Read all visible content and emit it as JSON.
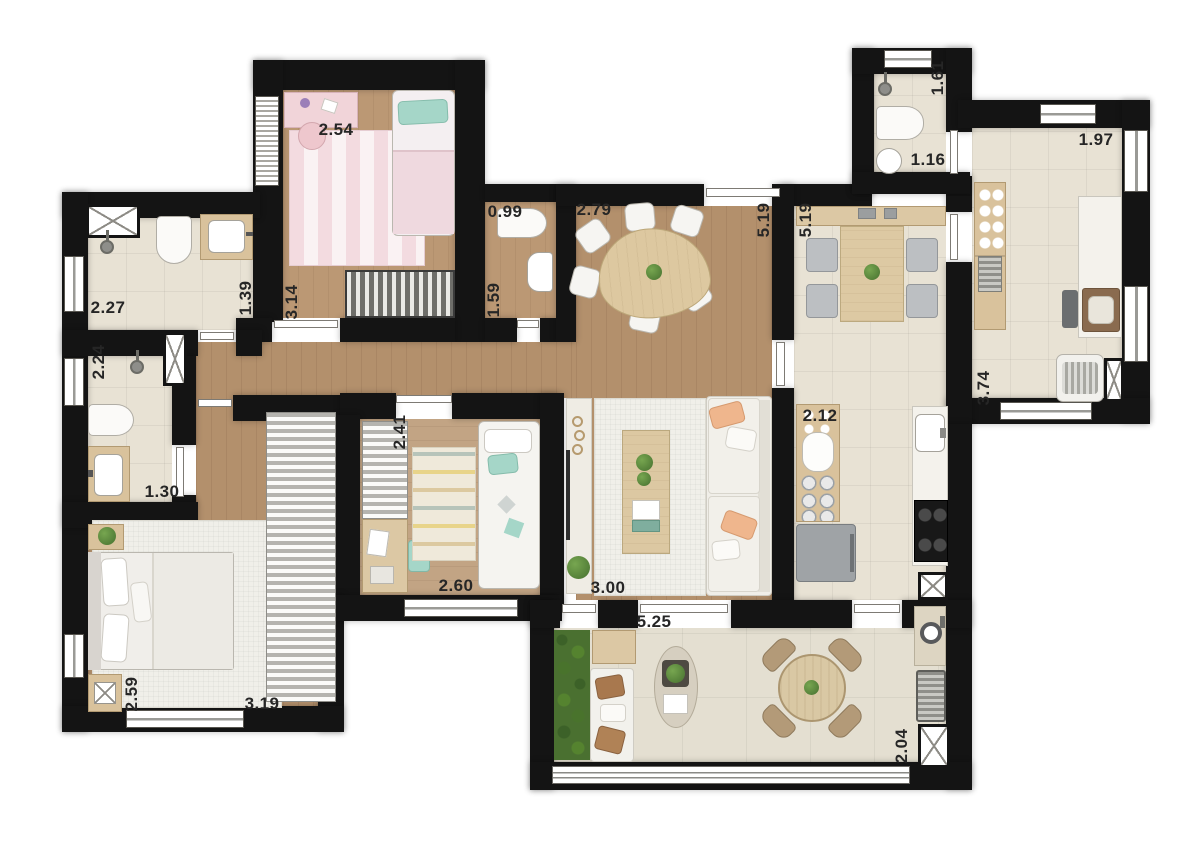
{
  "plan": {
    "type": "apartment-floor-plan",
    "unit_hint": "meters",
    "dimensions": [
      {
        "room": "child-bedroom-1",
        "value": "2.54",
        "orientation": "horizontal"
      },
      {
        "room": "bathroom-top-right",
        "value": "1.61",
        "orientation": "vertical"
      },
      {
        "room": "laundry",
        "value": "1.97",
        "orientation": "horizontal"
      },
      {
        "room": "bathroom-top-right",
        "value": "1.16",
        "orientation": "horizontal"
      },
      {
        "room": "lavatory",
        "value": "0.99",
        "orientation": "horizontal"
      },
      {
        "room": "dining-room",
        "value": "2.79",
        "orientation": "horizontal"
      },
      {
        "room": "dining-room",
        "value": "5.19",
        "orientation": "vertical"
      },
      {
        "room": "kitchen",
        "value": "5.19",
        "orientation": "vertical"
      },
      {
        "room": "bathroom-1",
        "value": "2.27",
        "orientation": "horizontal"
      },
      {
        "room": "bathroom-1",
        "value": "1.39",
        "orientation": "vertical"
      },
      {
        "room": "child-bedroom-1",
        "value": "3.14",
        "orientation": "vertical"
      },
      {
        "room": "lavatory",
        "value": "1.59",
        "orientation": "vertical"
      },
      {
        "room": "bathroom-2",
        "value": "2.24",
        "orientation": "vertical"
      },
      {
        "room": "laundry",
        "value": "3.74",
        "orientation": "vertical"
      },
      {
        "room": "bathroom-2",
        "value": "1.30",
        "orientation": "horizontal"
      },
      {
        "room": "child-bedroom-2",
        "value": "2.41",
        "orientation": "vertical"
      },
      {
        "room": "kitchen-counter",
        "value": "2.12",
        "orientation": "horizontal"
      },
      {
        "room": "master-bedroom",
        "value": "2.59",
        "orientation": "vertical"
      },
      {
        "room": "master-bedroom",
        "value": "3.19",
        "orientation": "horizontal"
      },
      {
        "room": "child-bedroom-2",
        "value": "2.60",
        "orientation": "horizontal"
      },
      {
        "room": "living-room",
        "value": "3.00",
        "orientation": "horizontal"
      },
      {
        "room": "terrace",
        "value": "5.25",
        "orientation": "horizontal"
      },
      {
        "room": "terrace",
        "value": "2.04",
        "orientation": "vertical"
      }
    ],
    "rooms": [
      {
        "id": "child-bedroom-1",
        "furniture": [
          "desk",
          "chair",
          "single-bed",
          "striped-rug",
          "wardrobe"
        ]
      },
      {
        "id": "bathroom-1",
        "furniture": [
          "shower",
          "toilet",
          "sink-counter",
          "ventilation-shaft"
        ]
      },
      {
        "id": "bathroom-2",
        "furniture": [
          "shower",
          "toilet",
          "sink-counter"
        ]
      },
      {
        "id": "lavatory",
        "furniture": [
          "toilet",
          "sink"
        ]
      },
      {
        "id": "hallway",
        "furniture": []
      },
      {
        "id": "master-bedroom",
        "furniture": [
          "double-bed",
          "nightstand",
          "nightstand",
          "rug",
          "wardrobe"
        ]
      },
      {
        "id": "child-bedroom-2",
        "furniture": [
          "wardrobe",
          "desk",
          "patterned-rug",
          "single-bed"
        ]
      },
      {
        "id": "dining-room",
        "furniture": [
          "organic-dining-table",
          "six-chairs"
        ]
      },
      {
        "id": "living-room",
        "furniture": [
          "tv-sideboard",
          "rug",
          "coffee-table",
          "sofa"
        ]
      },
      {
        "id": "kitchen",
        "furniture": [
          "breakfast-table",
          "four-chairs",
          "sideboard",
          "counter",
          "fridge",
          "sink",
          "cooktop"
        ]
      },
      {
        "id": "bathroom-top-right",
        "furniture": [
          "shower",
          "toilet",
          "round-sink"
        ]
      },
      {
        "id": "laundry",
        "furniture": [
          "dish-cabinet",
          "counter",
          "laundry-sink",
          "washing-machine"
        ]
      },
      {
        "id": "terrace",
        "furniture": [
          "vertical-garden",
          "outdoor-sofa",
          "oval-coffee-table",
          "round-table",
          "four-chairs",
          "round-sink",
          "barbecue-grill"
        ]
      }
    ],
    "colors": {
      "wall": "#141414",
      "wood_floor": "#b3906c",
      "wood_floor_light": "#c2a484",
      "tile_floor": "#e8e2d4",
      "terrace_tile": "#e4dfd1",
      "accent_teal": "#a5d6c8",
      "accent_pink": "#f1d4d9",
      "accent_peach": "#efb68d",
      "plant_green": "#5c8f3f",
      "counter_wood": "#d9c29c",
      "chair_gray": "#bcbfc2"
    }
  }
}
